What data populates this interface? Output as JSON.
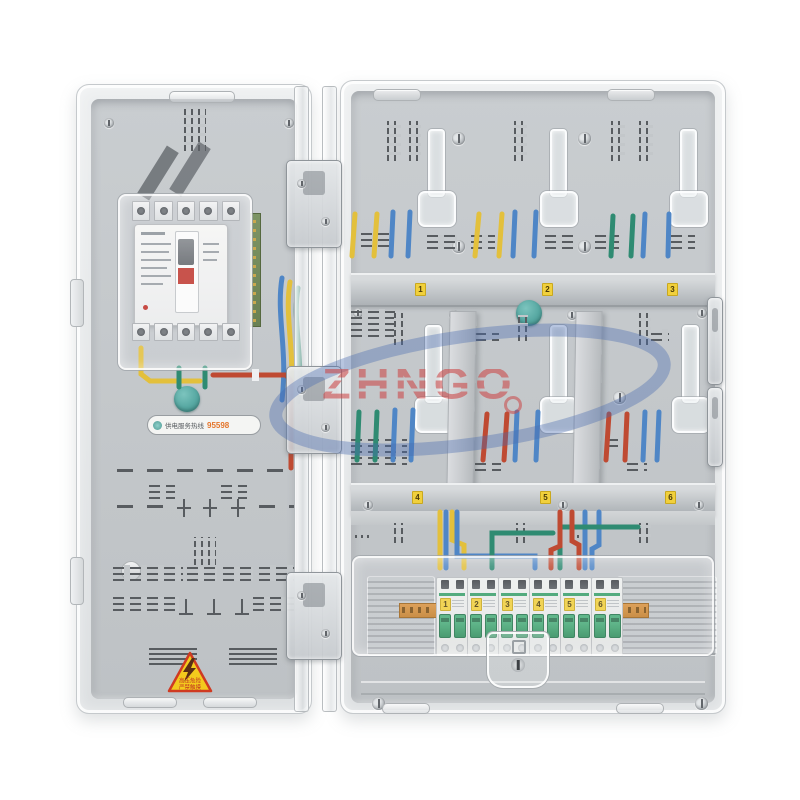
{
  "watermark": {
    "brand": "ZHNGO",
    "registered": "®",
    "brand_color": "#cb4646",
    "swoosh_color": "#4a6cb0"
  },
  "left_door": {
    "hotline": {
      "icon": "globe-icon",
      "text": "供电服务热线",
      "number": "95598"
    },
    "warning": {
      "symbol": "lightning-bolt",
      "line1": "高压危险",
      "line2": "严禁触摸"
    }
  },
  "right_panel": {
    "rail_top_labels": [
      "1",
      "2",
      "3"
    ],
    "rail_mid_labels": [
      "4",
      "5",
      "6"
    ],
    "mini_breakers": [
      {
        "number": "1"
      },
      {
        "number": "2"
      },
      {
        "number": "3"
      },
      {
        "number": "4"
      },
      {
        "number": "5"
      },
      {
        "number": "6"
      }
    ]
  },
  "colors": {
    "wire_yellow": "#e3c03c",
    "wire_blue": "#4f86c6",
    "wire_green": "#2f8b72",
    "wire_red": "#bf4a32",
    "seal_knob": "#57a8a2",
    "breaker_toggle_green": "#3aa06a",
    "din_rail_orange": "#d08a33",
    "number_sticker_yellow": "#f1d03c",
    "warning_yellow": "#f3ca1d",
    "warning_red": "#cf3a22"
  }
}
